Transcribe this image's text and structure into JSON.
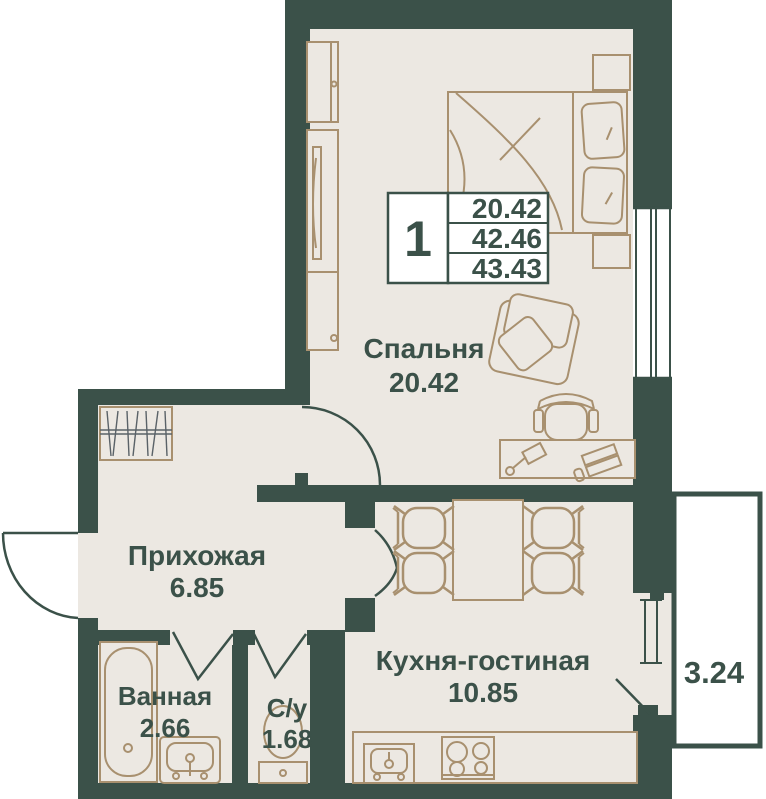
{
  "colors": {
    "wall": "#3B5149",
    "floor": "#ECE8E2",
    "furniture": "#A8906F",
    "hatch": "#5A6268",
    "text": "#3B5149",
    "paper": "#FFFFFF"
  },
  "info_card": {
    "unit_number": "1",
    "rows": [
      "20.42",
      "42.46",
      "43.43"
    ]
  },
  "rooms": {
    "bedroom": {
      "name": "Спальня",
      "area": "20.42"
    },
    "hallway": {
      "name": "Прихожая",
      "area": "6.85"
    },
    "bathroom": {
      "name": "Ванная",
      "area": "2.66"
    },
    "wc": {
      "name": "С/у",
      "area": "1.68"
    },
    "kitchen": {
      "name": "Кухня-гостиная",
      "area": "10.85"
    },
    "balcony": {
      "area": "3.24"
    }
  }
}
